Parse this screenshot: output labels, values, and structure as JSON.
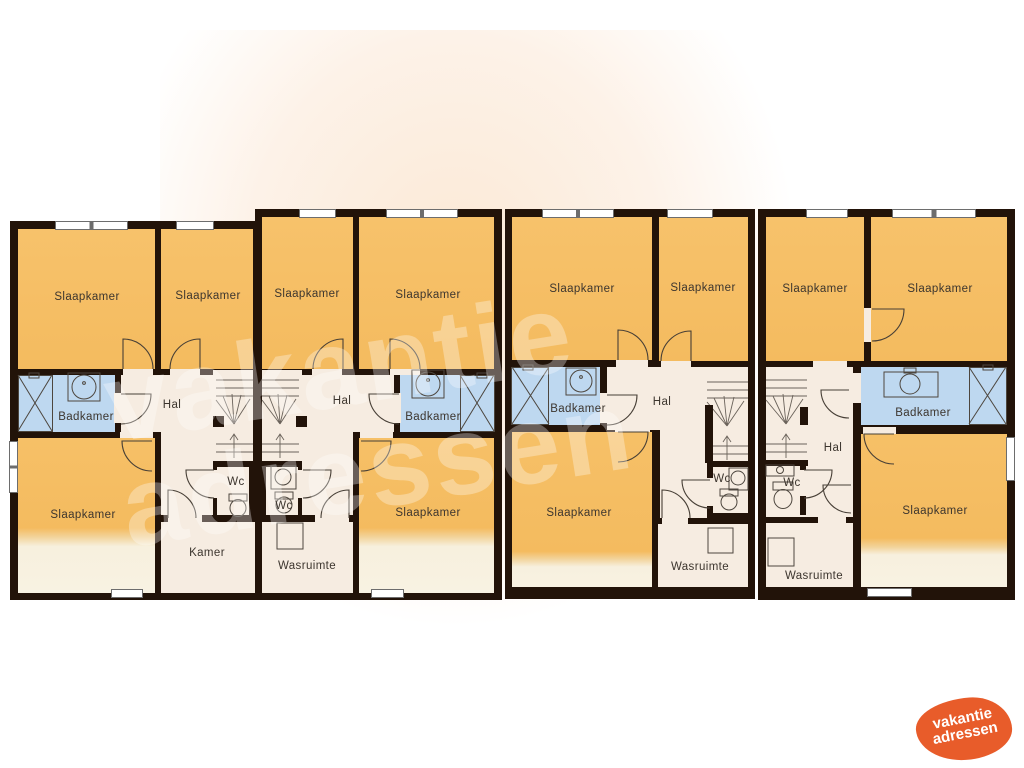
{
  "title": "Plattegrond vakantiewoningen - verdieping",
  "watermark": {
    "line1": "vakantie",
    "line2": "adressen"
  },
  "logo": {
    "line1": "vakantie",
    "line2": "adressen"
  },
  "colors": {
    "bedroom_orange": "#f4bb5f",
    "bathroom_blue": "#bed8f0",
    "hall_cream": "#f6ece1",
    "wall_dark": "#221309",
    "logo_orange": "#e85c2a",
    "fade_cream": "#f8f2e2"
  },
  "units": [
    {
      "id": "woning-1",
      "rooms": {
        "slaapkamer_1": "Slaapkamer",
        "slaapkamer_2": "Slaapkamer",
        "badkamer": "Badkamer",
        "hal": "Hal",
        "slaapkamer_3": "Slaapkamer",
        "wc": "Wc",
        "kamer": "Kamer"
      }
    },
    {
      "id": "woning-2",
      "rooms": {
        "slaapkamer_1": "Slaapkamer",
        "slaapkamer_2": "Slaapkamer",
        "badkamer": "Badkamer",
        "hal": "Hal",
        "slaapkamer_3": "Slaapkamer",
        "wc": "Wc",
        "wasruimte": "Wasruimte"
      }
    },
    {
      "id": "woning-3",
      "rooms": {
        "slaapkamer_1": "Slaapkamer",
        "slaapkamer_2": "Slaapkamer",
        "badkamer": "Badkamer",
        "hal": "Hal",
        "slaapkamer_3": "Slaapkamer",
        "wc": "Wc",
        "wasruimte": "Wasruimte"
      }
    },
    {
      "id": "woning-4",
      "rooms": {
        "slaapkamer_1": "Slaapkamer",
        "slaapkamer_2": "Slaapkamer",
        "badkamer": "Badkamer",
        "hal": "Hal",
        "slaapkamer_3": "Slaapkamer",
        "wc": "Wc",
        "wasruimte": "Wasruimte"
      }
    }
  ]
}
